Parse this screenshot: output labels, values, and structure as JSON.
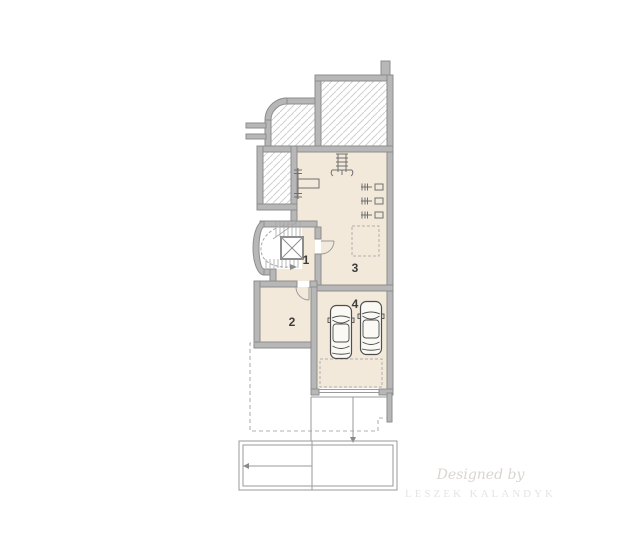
{
  "rooms": {
    "r1": {
      "label": "1"
    },
    "r2": {
      "label": "2"
    },
    "r3": {
      "label": "3"
    },
    "r4": {
      "label": "4"
    }
  },
  "watermark": {
    "line1": "Designed by",
    "line2": "LESZEK KALANDYK"
  },
  "colors": {
    "wall_fill": "#b7b7b7",
    "wall_stroke": "#8e8e8e",
    "room_fill": "#f3e9da",
    "hatch": "#cfcfcf",
    "line": "#9a9a9a",
    "dashed": "#b0b0b0",
    "label": "#3c3c3c",
    "watermark_script": "#d9d5d1",
    "watermark_caps": "#e7e4e1"
  },
  "icons": [
    "spiral-stairs-icon",
    "elevator-icon",
    "bench-press-icon",
    "exercise-machine-icon",
    "dumbbell-rack-icon",
    "car-icon",
    "door-arc-icon",
    "garage-door-icon",
    "slope-arrow-icon"
  ]
}
